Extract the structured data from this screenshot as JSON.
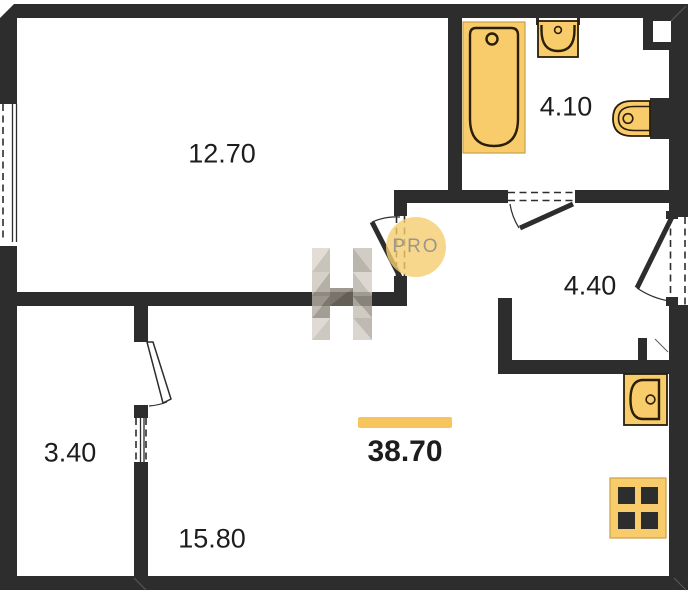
{
  "plan": {
    "rooms": [
      {
        "id": "living-room",
        "area": "12.70"
      },
      {
        "id": "bathroom",
        "area": "4.10"
      },
      {
        "id": "hallway",
        "area": "4.40"
      },
      {
        "id": "balcony",
        "area": "3.40"
      },
      {
        "id": "kitchen-living-room",
        "area": "15.80"
      }
    ],
    "total_area": "38.70",
    "watermark": {
      "badge": "PRO"
    },
    "fixtures": [
      {
        "id": "bathtub"
      },
      {
        "id": "washbasin"
      },
      {
        "id": "toilet"
      },
      {
        "id": "kitchen-sink"
      },
      {
        "id": "stove"
      }
    ],
    "colors": {
      "wall": "#2d2d2d",
      "fixture-fill": "#f9cc6b",
      "fixture-stroke": "#2a1e08",
      "fixture-edge": "#c9a04a",
      "accent-bar": "#f6c55e",
      "pro-circle": "#f5cd6e",
      "pro-text": "#9b968c",
      "label-text": "#1d1d1d"
    }
  }
}
